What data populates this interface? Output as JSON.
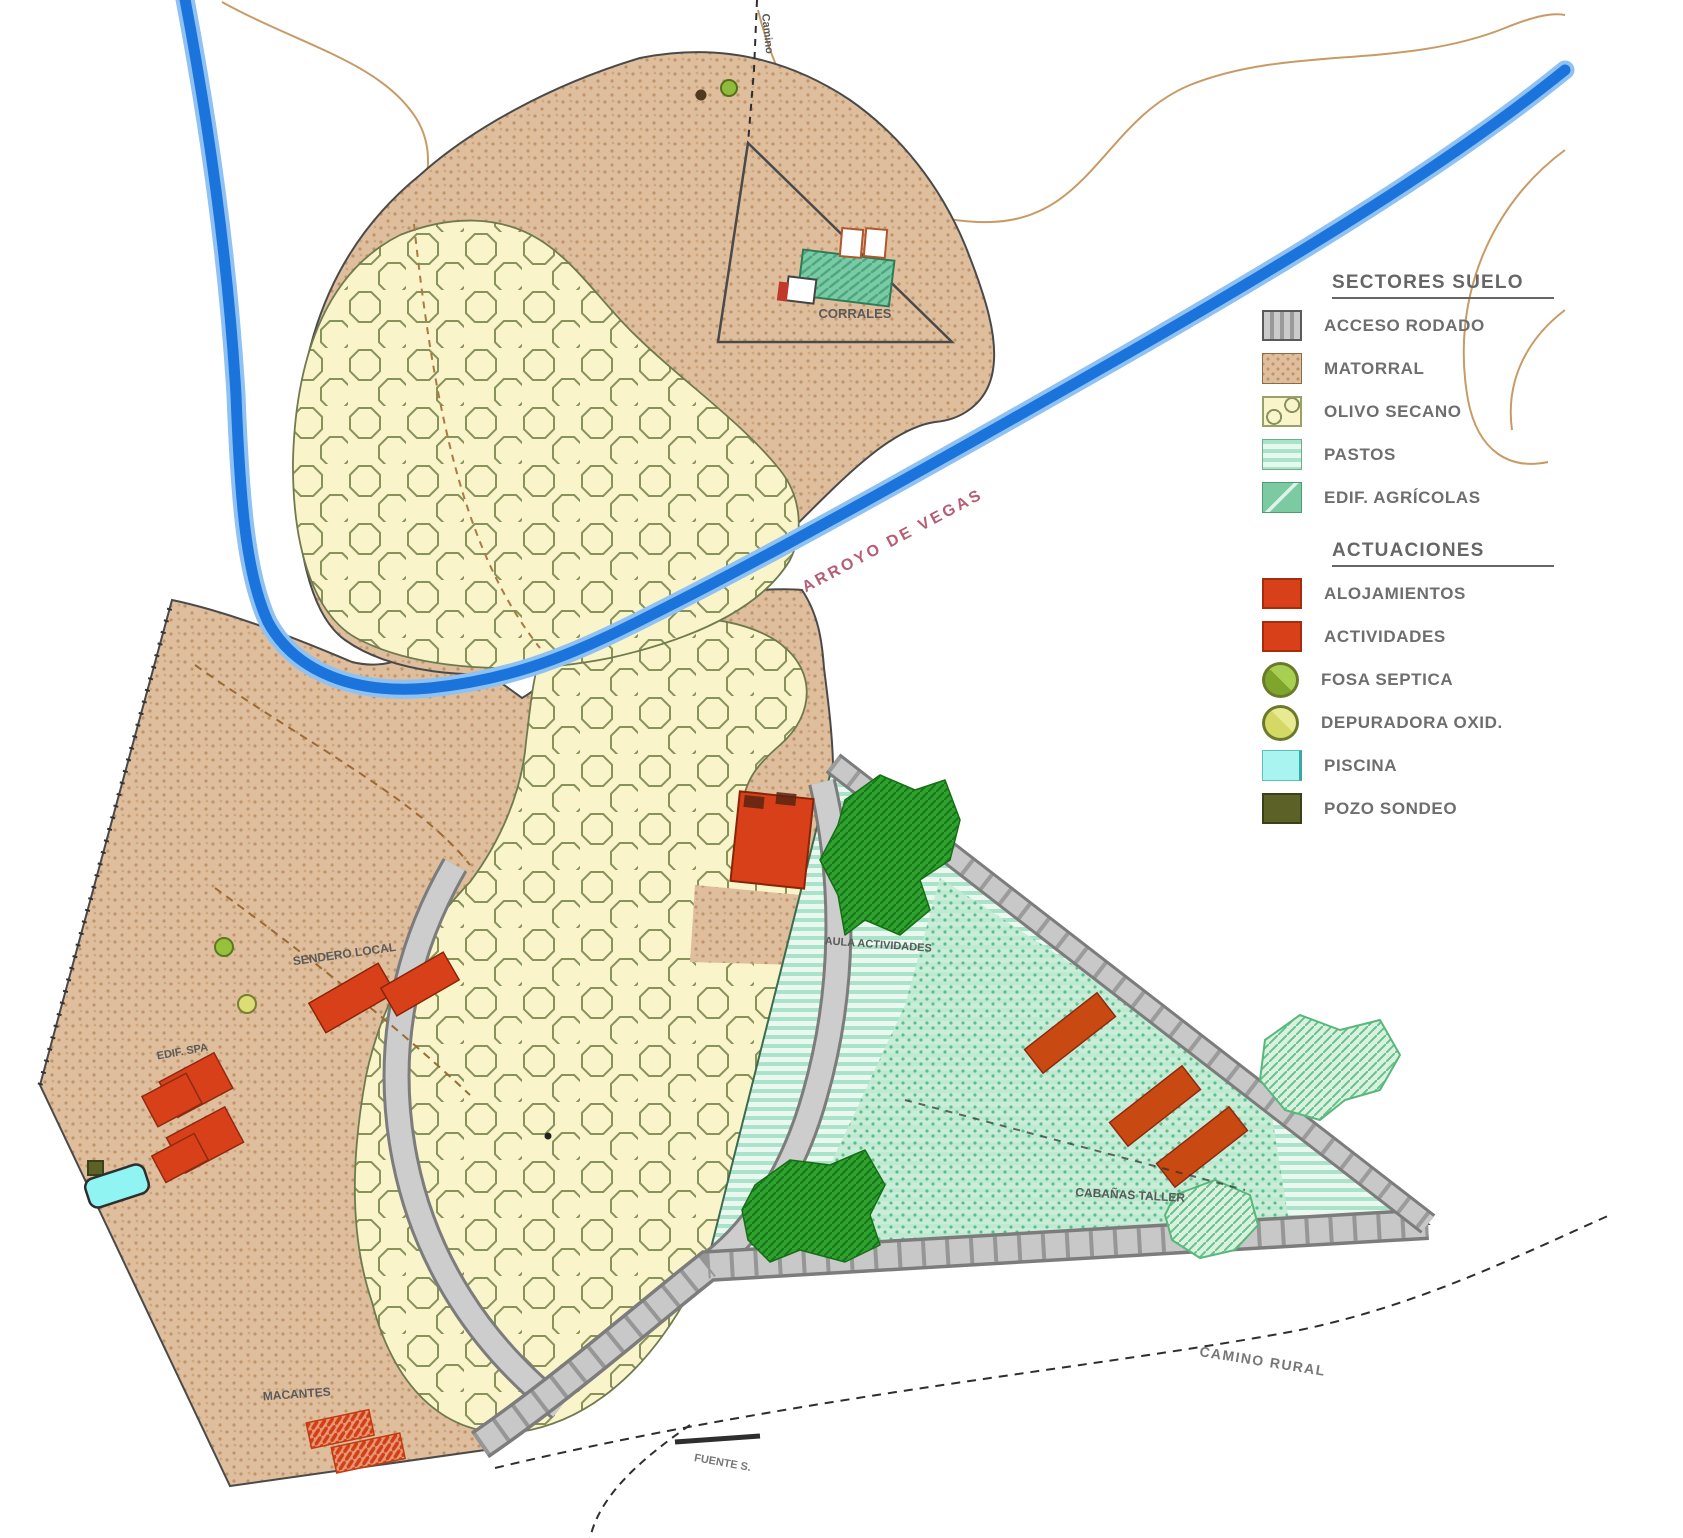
{
  "legend": {
    "sectores": {
      "title": "SECTORES SUELO",
      "items": [
        {
          "label": "ACCESO RODADO",
          "swatch": "acceso-rodado"
        },
        {
          "label": "MATORRAL",
          "swatch": "matorral"
        },
        {
          "label": "OLIVO SECANO",
          "swatch": "olivo-secano"
        },
        {
          "label": "PASTOS",
          "swatch": "pastos"
        },
        {
          "label": "EDIF. AGRÍCOLAS",
          "swatch": "edif-agricolas"
        }
      ]
    },
    "actuaciones": {
      "title": "ACTUACIONES",
      "items": [
        {
          "label": "ALOJAMIENTOS",
          "swatch": "alojamientos"
        },
        {
          "label": "ACTIVIDADES",
          "swatch": "actividades"
        },
        {
          "label": "FOSA SEPTICA",
          "swatch": "fosa-septica"
        },
        {
          "label": "DEPURADORA OXID.",
          "swatch": "depuradora-oxid"
        },
        {
          "label": "PISCINA",
          "swatch": "piscina"
        },
        {
          "label": "POZO SONDEO",
          "swatch": "pozo-sondeo"
        }
      ]
    }
  },
  "map_labels": {
    "corrales": "CORRALES",
    "arroyo": "ARROYO DE VEGAS",
    "camino_top": "Camino",
    "sendero": "SENDERO LOCAL",
    "edif_spa": "EDIF. SPA",
    "aula_actividades": "AULA ACTIVIDADES",
    "cabanas": "CABAÑAS TALLER",
    "camino_rural": "CAMINO RURAL",
    "fuente": "FUENTE S.",
    "macantes": "MACANTES"
  },
  "colors": {
    "river_core": "#1b74dc",
    "river_edge": "#8fc1f2",
    "matorral": "#debe9c",
    "olivo": "#f9f4c9",
    "pastos": "#cfeede",
    "vegetation_green": "#2ea12e",
    "edif_agricolas": "#7ccaa2",
    "actuacion_red": "#d8401a",
    "road_gray": "#c8c8c8",
    "piscina_cyan": "#8ff4f2",
    "fosa_green": "#97c03c",
    "depuradora_yellow": "#dcde75",
    "pozo_olive": "#5c6127",
    "contour_tan": "#c89b66",
    "arroyo_label_red": "#b65c74"
  }
}
